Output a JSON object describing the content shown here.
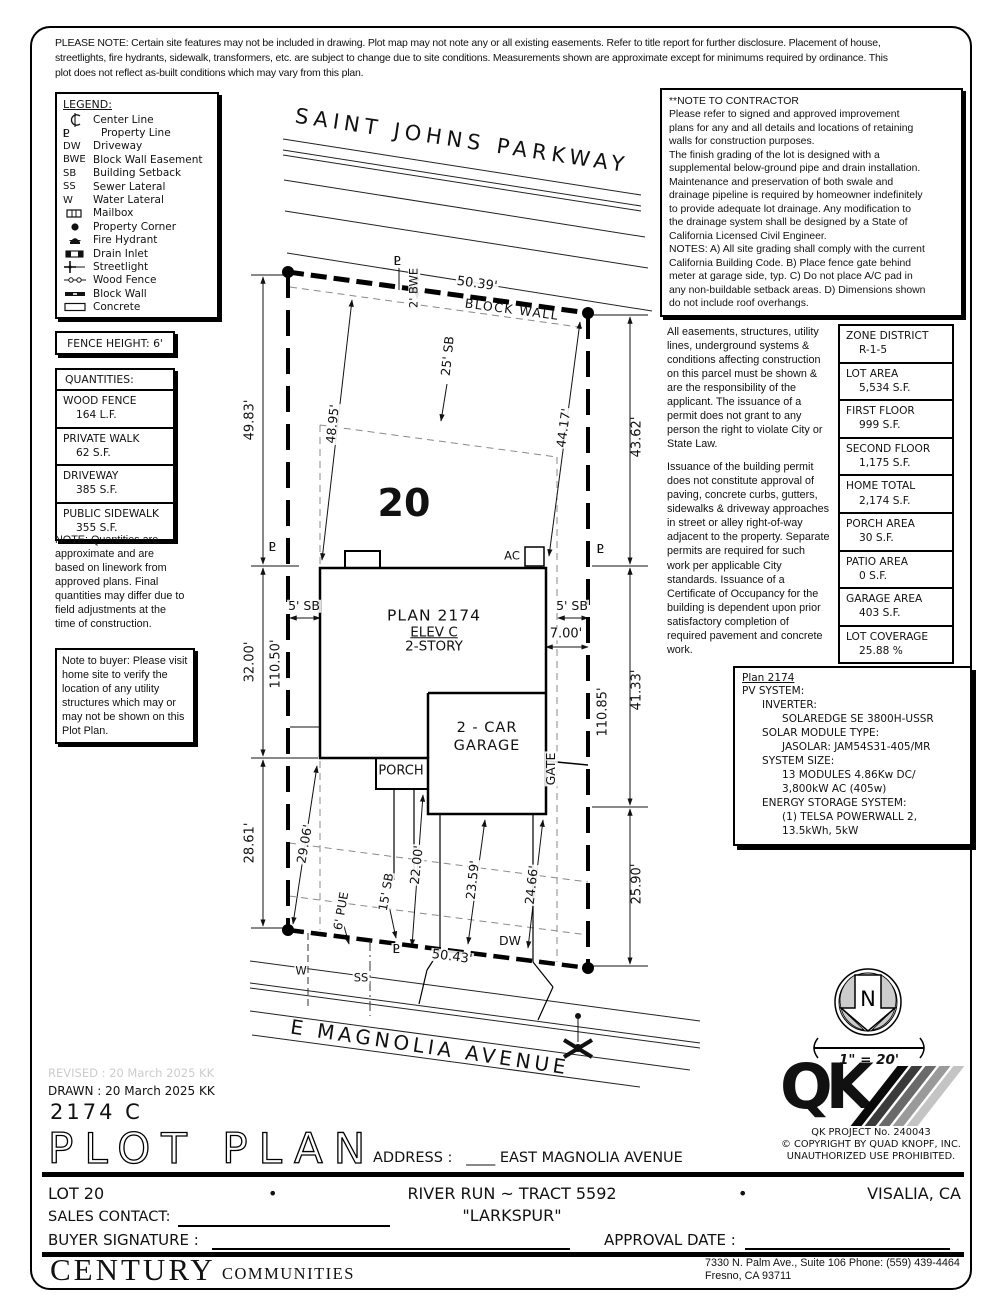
{
  "header": {
    "disclaimer": "PLEASE NOTE:  Certain site features may not be included in drawing.  Plot map may not note any or all existing easements. Refer to title report for further disclosure.  Placement of house,\nstreetlights, fire hydrants, sidewalk, transformers, etc. are subject to change due to site conditions.  Measurements shown are approximate except for minimums required by ordinance.  This\nplot does not reflect as-built conditions which may vary from this plan."
  },
  "legend": {
    "title": "LEGEND:",
    "items": [
      {
        "key": "",
        "label": "Center Line"
      },
      {
        "key": "PL",
        "label": "Property Line"
      },
      {
        "key": "DW",
        "label": "Driveway"
      },
      {
        "key": "BWE",
        "label": "Block Wall Easement"
      },
      {
        "key": "SB",
        "label": "Building Setback"
      },
      {
        "key": "SS",
        "label": "Sewer Lateral"
      },
      {
        "key": "W",
        "label": "Water Lateral"
      },
      {
        "key": "",
        "label": "Mailbox"
      },
      {
        "key": "",
        "label": "Property Corner"
      },
      {
        "key": "",
        "label": "Fire Hydrant"
      },
      {
        "key": "",
        "label": "Drain Inlet"
      },
      {
        "key": "",
        "label": "Streetlight"
      },
      {
        "key": "",
        "label": "Wood Fence"
      },
      {
        "key": "",
        "label": "Block Wall"
      },
      {
        "key": "",
        "label": "Concrete"
      }
    ]
  },
  "contractor": {
    "title": "**NOTE TO CONTRACTOR",
    "body": "Please refer to signed and approved improvement\nplans for any and all details and locations of retaining\nwalls for construction purposes.\nThe finish grading of the lot is designed with a\nsupplemental below-ground pipe and drain installation.\nMaintenance and preservation of both swale and\ndrainage pipeline is required by homeowner indefinitely\nto provide adequate lot drainage.  Any modification to\nthe drainage system shall be designed by a State of\nCalifornia Licensed Civil Engineer.\nNOTES:  A) All site grading shall comply with the current\nCalifornia Building Code.  B) Place fence gate behind\nmeter at garage side, typ.  C) Do not place A/C pad in\nany non-buildable setback areas.  D) Dimensions shown\ndo not include roof overhangs."
  },
  "easement": {
    "p1": "All easements, structures, utility lines, underground systems & conditions affecting construction on this parcel must be shown & are the responsibility of the applicant. The issuance of a permit does not grant to any person the right to violate City or State Law.",
    "p2": "Issuance of the building permit does not constitute approval of paving, concrete curbs, gutters, sidewalks & driveway approaches in street or alley right-of-way adjacent to the property. Separate permits are required for such work per applicable City standards. Issuance of a Certificate of Occupancy for the building is dependent upon prior satisfactory completion of required pavement and concrete work."
  },
  "zone_table": {
    "rows": [
      {
        "label": "ZONE DISTRICT",
        "value": "R-1-5"
      },
      {
        "label": "LOT AREA",
        "value": "5,534 S.F."
      },
      {
        "label": "FIRST FLOOR",
        "value": "999 S.F."
      },
      {
        "label": "SECOND FLOOR",
        "value": "1,175 S.F."
      },
      {
        "label": "HOME TOTAL",
        "value": "2,174 S.F."
      },
      {
        "label": "PORCH AREA",
        "value": "30 S.F."
      },
      {
        "label": "PATIO AREA",
        "value": "0 S.F."
      },
      {
        "label": "GARAGE AREA",
        "value": "403 S.F."
      },
      {
        "label": "LOT COVERAGE",
        "value": "25.88 %"
      }
    ]
  },
  "left_panel": {
    "fence": "FENCE HEIGHT: 6'",
    "quantities_title": "QUANTITIES:",
    "quantities": [
      {
        "label": "WOOD FENCE",
        "value": "164 L.F."
      },
      {
        "label": "PRIVATE WALK",
        "value": "62 S.F."
      },
      {
        "label": "DRIVEWAY",
        "value": "385 S.F."
      },
      {
        "label": "PUBLIC SIDEWALK",
        "value": "355 S.F."
      }
    ],
    "note": "NOTE: Quantities are approximate and are based on linework from approved plans.  Final quantities may differ due to field adjustments at the time of construction.",
    "buyer_note": "Note to buyer: Please visit home site to verify the location of any utility structures which may or may not be shown on this Plot Plan."
  },
  "pv": {
    "title": "Plan 2174",
    "body": "PV SYSTEM:\n      INVERTER:\n            SOLAREDGE SE 3800H-USSR\n      SOLAR MODULE TYPE:\n            JASOLAR: JAM54S31-405/MR\n      SYSTEM SIZE:\n            13 MODULES 4.86Kw DC/\n            3,800kW AC (405w)\n      ENERGY STORAGE SYSTEM:\n            (1) TELSA POWERWALL 2,\n            13.5kWh, 5kW"
  },
  "plan": {
    "street_top": "SAINT JOHNS PARKWAY",
    "street_bottom": "E MAGNOLIA AVENUE",
    "lot_number": "20",
    "plan_name": "PLAN 2174",
    "elev": "ELEV C",
    "story": "2-STORY",
    "garage1": "2 - CAR",
    "garage2": "GARAGE",
    "porch": "PORCH",
    "gate": "GATE",
    "ac": "AC",
    "dw": "DW",
    "block_wall": "BLOCK WALL",
    "pl": "PL",
    "w": "W",
    "ss": "SS",
    "dims": {
      "bwe": "2' BWE",
      "top": "50.39'",
      "sb25": "25' SB",
      "left_diag": "48.95'",
      "right_diag": "44.17'",
      "l1": "49.83'",
      "l2": "32.00'",
      "l3": "28.61'",
      "l_pl": "110.50'",
      "r1": "43.62'",
      "r2": "41.33'",
      "r3": "25.90'",
      "r_pl": "110.85'",
      "sb5": "5' SB",
      "gar_pl": "7.00'",
      "ll_diag": "29.06'",
      "walk": "22.00'",
      "dw1": "23.59'",
      "dw2": "24.66'",
      "sb15": "15' SB",
      "pue": "6' PUE",
      "bottom": "50.43'"
    }
  },
  "north": {
    "label": "N",
    "scale": "1\" = 20'"
  },
  "qk": {
    "logo": "QK",
    "project": "QK PROJECT No. 240043",
    "copyright": "©   COPYRIGHT BY QUAD KNOPF, INC.",
    "notice": "UNAUTHORIZED USE PROHIBITED."
  },
  "titleblock": {
    "revised": "REVISED :  20 March 2025  KK",
    "drawn": "DRAWN :  20 March 2025  KK",
    "plan_code": "2174  C",
    "title": "PLOT PLAN",
    "address_label": "ADDRESS :",
    "address_value": "____ EAST MAGNOLIA AVENUE",
    "lot": "LOT 20",
    "bullet": "•",
    "tract": "RIVER RUN ~ TRACT 5592",
    "city": "VISALIA, CA",
    "community": "\"LARKSPUR\"",
    "sales_label": "SALES CONTACT:",
    "buyer_label": "BUYER SIGNATURE :",
    "approval_label": "APPROVAL DATE :",
    "company": "CENTURY",
    "company2": "COMMUNITIES",
    "addr1": "7330 N. Palm Ave., Suite 106   Phone:  (559) 439-4464",
    "addr2": "Fresno, CA  93711"
  }
}
